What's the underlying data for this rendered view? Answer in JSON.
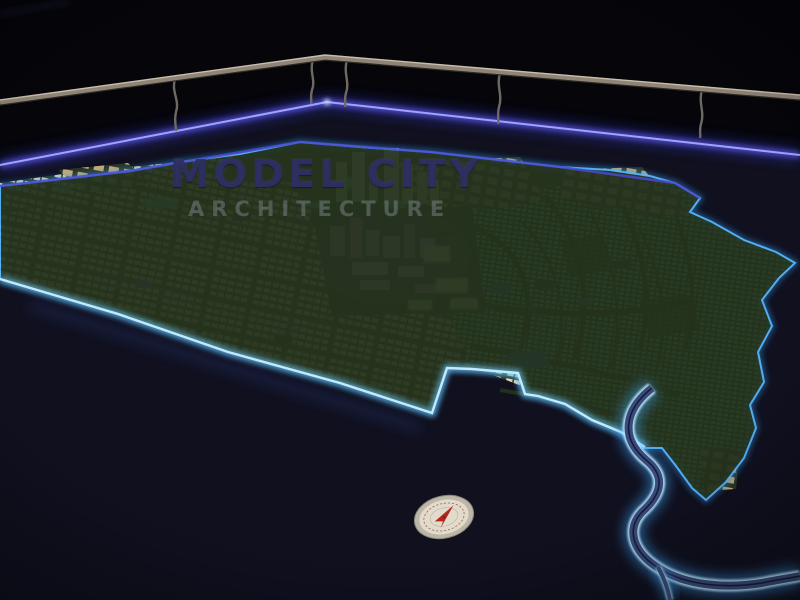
{
  "watermark": {
    "line1": "MODEL CITY",
    "line2": "ARCHITECTURE"
  },
  "colors": {
    "background": "#05050a",
    "table_surface": "#10101f",
    "table_edge_led": "#a8a8ff",
    "coastline_led": "#58b8ff",
    "coast_bright_led": "#c8ecff",
    "river_bank_led": "#bfeaff",
    "residential_cream": "#ead9ae",
    "residential_teal": "#5ceccd",
    "cluster_tan": "#c7aa78",
    "downtown_magenta": "#d48ae8",
    "downtown_warm_white": "#f5efd8",
    "terrain_green": "#25331d",
    "handrail_metal": "#8f8577",
    "compass_face": "#e2dbcb",
    "compass_needle": "#b3261e"
  }
}
